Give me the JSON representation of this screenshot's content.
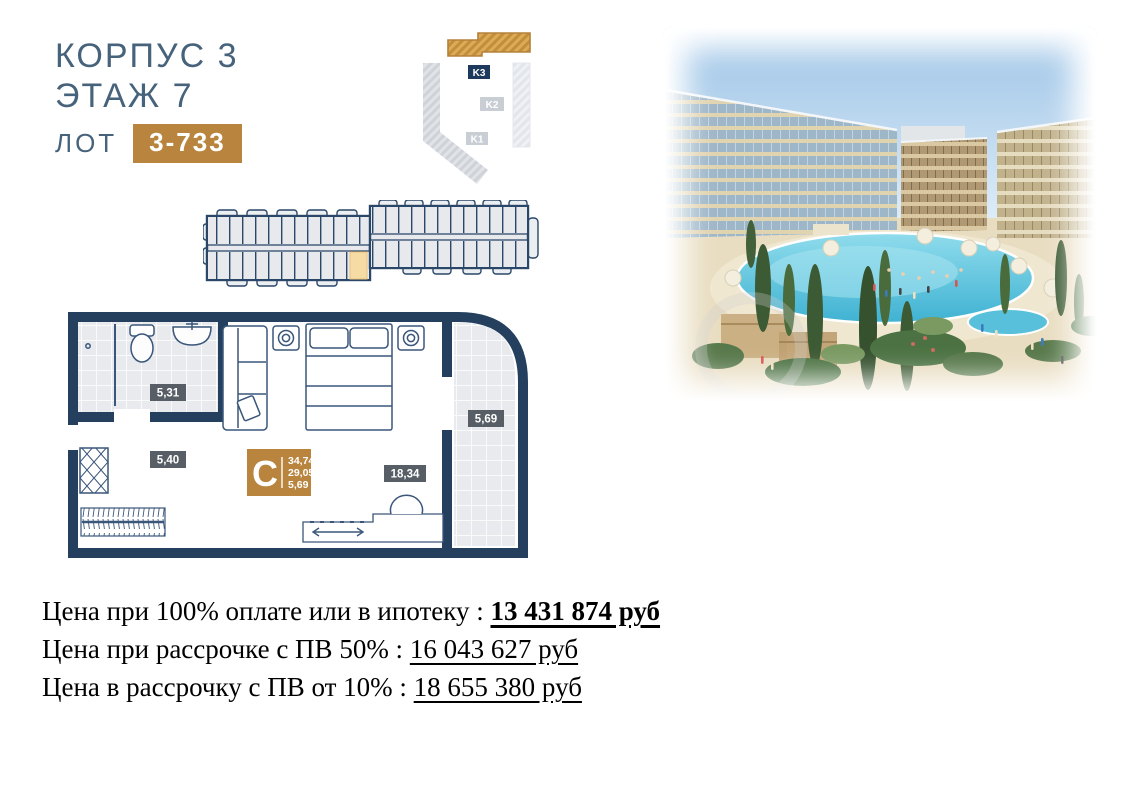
{
  "header": {
    "building": "КОРПУС 3",
    "floor": "ЭТАЖ 7",
    "lot_label": "ЛОТ",
    "lot_value": "3-733"
  },
  "site_plan": {
    "k3_label": "K3",
    "k2_label": "K2",
    "k1_label": "K1",
    "highlighted_building": "K3"
  },
  "unit_plan": {
    "type_letter": "C",
    "area_values": {
      "total": "34,74",
      "living": "29,05",
      "balcony": "5,69"
    },
    "room_areas": {
      "bathroom": "5,31",
      "hall": "5,40",
      "living_room": "18,34",
      "balcony": "5,69"
    }
  },
  "prices": {
    "line1": {
      "label": "Цена при 100% оплате или в ипотеку :",
      "value": "13 431 874 руб"
    },
    "line2": {
      "label": "Цена при рассрочке с ПВ 50% :",
      "value": "16 043 627 руб"
    },
    "line3": {
      "label": "Цена в рассрочку с ПВ от 10% :",
      "value": "18 655 380 руб"
    }
  },
  "colors": {
    "accent_gold": "#b9853e",
    "navy_wall": "#24405e",
    "heading_text": "#47637c",
    "label_badge": "#575e66",
    "highlight_unit": "#f6dba4"
  }
}
